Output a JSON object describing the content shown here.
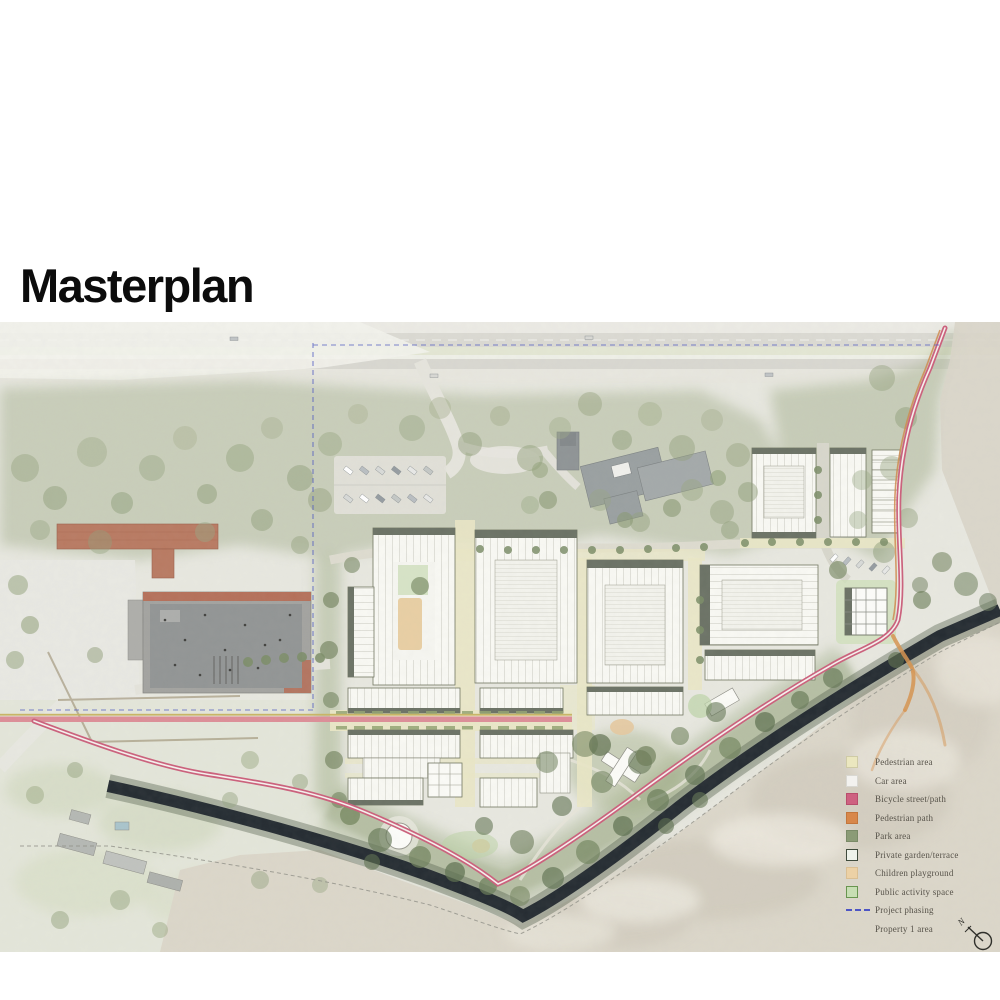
{
  "title": "Masterplan",
  "legend": {
    "items": [
      {
        "label": "Pedestrian area",
        "swatch": "fill",
        "fill": "#ebe7bf",
        "border": "#cfcba6"
      },
      {
        "label": "Car area",
        "swatch": "fill",
        "fill": "#f3f2ef",
        "border": "#d9d8d2"
      },
      {
        "label": "Bicycle street/path",
        "swatch": "fill",
        "fill": "#ce6181",
        "border": "#b84e6d"
      },
      {
        "label": "Pedestrian path",
        "swatch": "fill",
        "fill": "#d8874a",
        "border": "#c3763c"
      },
      {
        "label": "Park area",
        "swatch": "fill",
        "fill": "#8b9b76",
        "border": "#7a8a67"
      },
      {
        "label": "Private garden/terrace",
        "swatch": "fill",
        "fill": "#eef2ea",
        "border": "#3f4b3c"
      },
      {
        "label": "Children playground",
        "swatch": "fill",
        "fill": "#ecd1a5",
        "border": "#dabf93"
      },
      {
        "label": "Public activity space",
        "swatch": "fill",
        "fill": "#c7deb3",
        "border": "#68954f"
      },
      {
        "label": "Project phasing",
        "swatch": "dashed-line",
        "color": "#4d55c4"
      },
      {
        "label": "Property 1 area",
        "swatch": "none"
      }
    ]
  },
  "compass": {
    "north_label": "N"
  },
  "map_colors": {
    "canal": "#252c32",
    "bicycle_path": "#cb5f7b",
    "pedestrian_path": "#d6934f",
    "pedestrian_street": "#eae7c6",
    "park_green": "#8a9c72",
    "sand": "#dcd7ca",
    "phasing_line": "#4d59c0"
  }
}
